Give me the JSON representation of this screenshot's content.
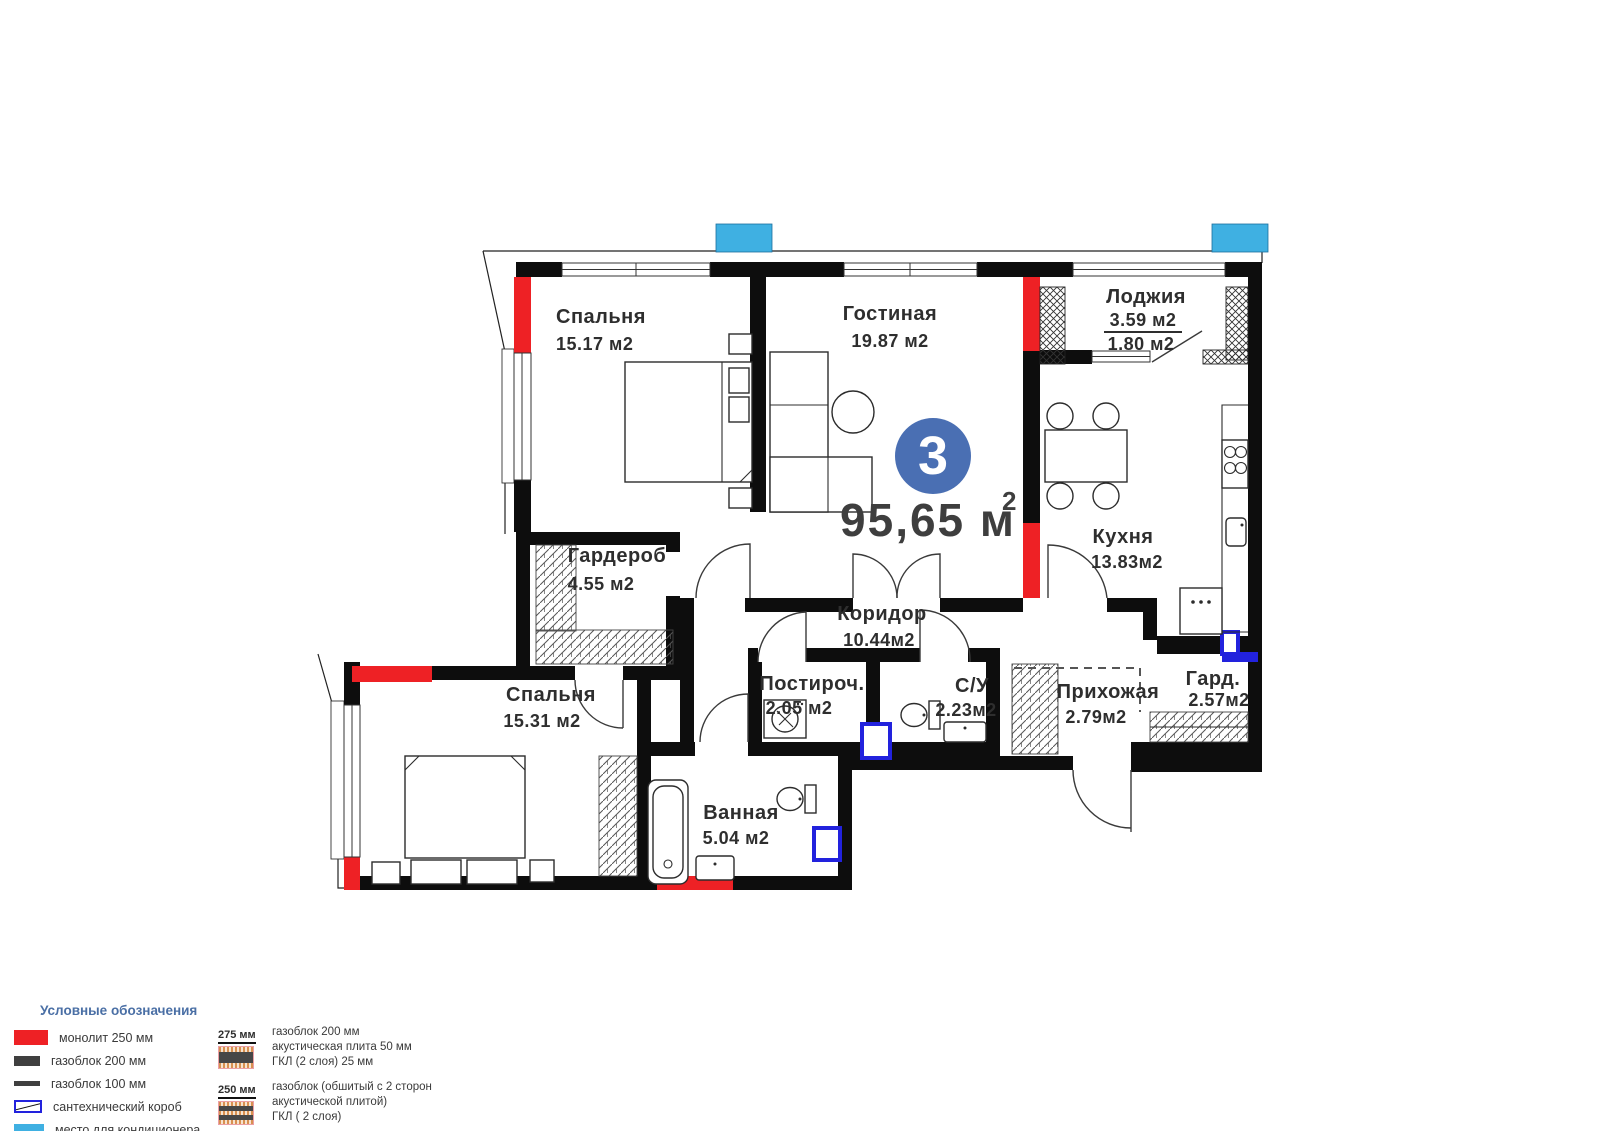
{
  "plan": {
    "badge": "3",
    "total": "95,65 м",
    "total_sup": "2",
    "rooms": [
      {
        "id": "bedroom1",
        "name": "Спальня",
        "area": "15.17 м2"
      },
      {
        "id": "living",
        "name": "Гостиная",
        "area": "19.87 м2"
      },
      {
        "id": "loggia",
        "name": "Лоджия",
        "area": "3.59 м2",
        "area2": "1.80 м2"
      },
      {
        "id": "kitchen",
        "name": "Кухня",
        "area": "13.83м2"
      },
      {
        "id": "wardrobe1",
        "name": "Гардероб",
        "area": "4.55 м2"
      },
      {
        "id": "corridor",
        "name": "Коридор",
        "area": "10.44м2"
      },
      {
        "id": "bedroom2",
        "name": "Спальня",
        "area": "15.31 м2"
      },
      {
        "id": "laundry",
        "name": "Постироч.",
        "area": "2.05 м2"
      },
      {
        "id": "wc",
        "name": "С/У",
        "area": "2.23м2"
      },
      {
        "id": "hall",
        "name": "Прихожая",
        "area": "2.79м2"
      },
      {
        "id": "wardrobe2",
        "name": "Гард.",
        "area": "2.57м2"
      },
      {
        "id": "bathroom",
        "name": "Ванная",
        "area": "5.04 м2"
      }
    ]
  },
  "legend": {
    "title": "Условные обозначения",
    "items": [
      {
        "label": "монолит 250 мм"
      },
      {
        "label": "газоблок 200 мм"
      },
      {
        "label": "газоблок 100 мм"
      },
      {
        "label": "сантехнический короб"
      },
      {
        "label": "место для кондиционера"
      }
    ],
    "wall_types": [
      {
        "size": "275 мм",
        "lines": [
          "газоблок 200 мм",
          "акустическая плита 50 мм",
          "ГКЛ (2 слоя) 25 мм"
        ]
      },
      {
        "size": "250 мм",
        "lines": [
          "газоблок (обшитый с 2 сторон",
          "акустической плитой)",
          "ГКЛ ( 2 слоя)"
        ]
      }
    ]
  },
  "colors": {
    "monolith_red": "#ee2125",
    "ac_blue": "#3fb0e2",
    "duct_blue": "#2222dd",
    "badge_blue": "#4a6fb3",
    "legend_header": "#4a6fa5"
  }
}
